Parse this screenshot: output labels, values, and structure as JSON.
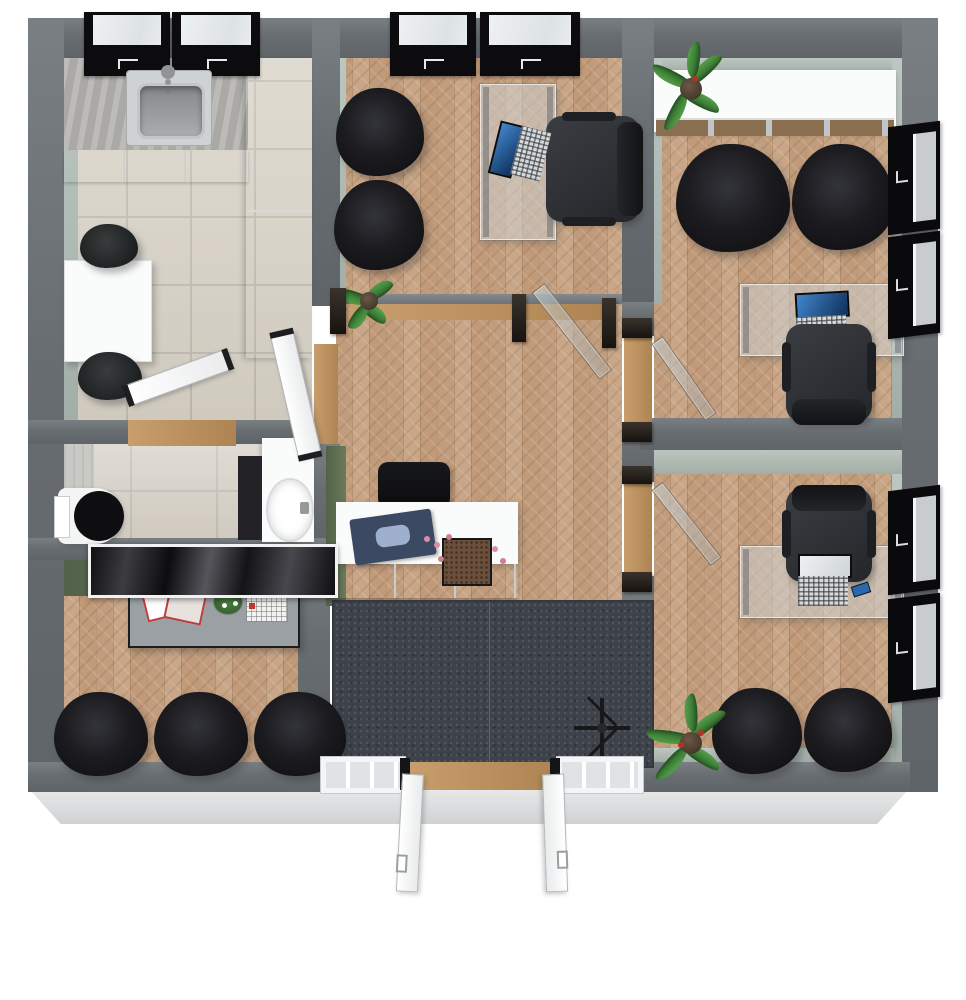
{
  "scene": {
    "view": "3d-floorplan-top-view",
    "description": "Rendered 3D top-down floor plan of a small office suite with reception, waiting area, kitchen, bathroom and four work rooms"
  },
  "palette": {
    "exterior_wall": "#6b7075",
    "interior_sage": "#b7c1bb",
    "accent_olive": "#5d6b4c",
    "wood_floor": "#c2a083",
    "tile_floor": "#d8d2c6",
    "entry_rug": "#3e434b",
    "window_frame": "#0c0c0e",
    "furniture_black": "#1a1a1d",
    "desk_glass": "rgba(208,214,218,0.5)",
    "door_white": "#f4f5f6",
    "laptop_screen_blue": "#2a6cb0"
  },
  "rooms": [
    {
      "name": "kitchen-break-room",
      "furniture": [
        "counter-with-sink",
        "two-wall-windows",
        "tall-cabinet",
        "dining-table",
        "two-dark-chairs"
      ]
    },
    {
      "name": "office-top-middle",
      "furniture": [
        "two-guest-chairs",
        "glass-desk",
        "laptop",
        "task-chair",
        "two-wall-windows",
        "floor-plant",
        "glass-partition-with-door"
      ]
    },
    {
      "name": "office-top-right",
      "furniture": [
        "white-credenza",
        "potted-plant",
        "two-lounge-chairs",
        "glass-desk",
        "laptop",
        "task-chair",
        "two-side-windows"
      ]
    },
    {
      "name": "office-bottom-right",
      "furniture": [
        "task-chair",
        "glass-desk",
        "laptop",
        "two-lounge-chairs",
        "floor-plant",
        "two-side-windows"
      ]
    },
    {
      "name": "hallway-reception",
      "furniture": [
        "reception-desk",
        "desk-chair",
        "ledger-book",
        "flower-box",
        "corridor-glass-doors"
      ]
    },
    {
      "name": "waiting-area",
      "furniture": [
        "wall-art",
        "coffee-table",
        "magazines",
        "flower-vase",
        "chessboard",
        "three-black-chairs"
      ]
    },
    {
      "name": "bathroom",
      "furniture": [
        "toilet",
        "vanity-with-basin",
        "white-door"
      ]
    },
    {
      "name": "entry",
      "furniture": [
        "dark-rug",
        "double-entry-doors",
        "coat-stand"
      ]
    }
  ]
}
